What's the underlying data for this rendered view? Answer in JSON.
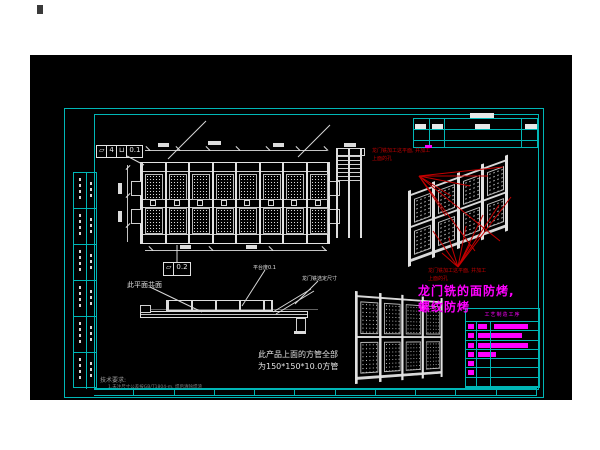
{
  "canvas": {
    "bg": "#000000",
    "line_color": "#e2e2e2",
    "border_color": "#00b6b6",
    "red": "#c40000",
    "magenta": "#ff00ff"
  },
  "tolerance_frame_1": {
    "symbol": "▱",
    "count": "4",
    "modifier": "⊔",
    "value": "0.1"
  },
  "tolerance_frame_2": {
    "symbol": "▱",
    "value": "0.2"
  },
  "notes": {
    "coplanar": "此平面共面",
    "platform_flatness": "平台度0.1",
    "mill_dims": "龙门铣选定尺寸",
    "red_machining_1": "龙门铣加工这平面, 并加工",
    "red_machining_2": "上面的孔",
    "magenta_1": "龙门铣的面防烤,",
    "magenta_2": "螺纹防烤",
    "product_1": "此产品上面的方管全部",
    "product_2": "为150*150*10.0方管",
    "tech_title": "技术要求:",
    "tech_item": "1.未注尺寸公差按GB/T1804-m, 焊后清除焊渣"
  },
  "bom": {
    "header": "工艺制造工序",
    "rows": [
      {
        "lead": true,
        "mid": 9,
        "bar": 34
      },
      {
        "lead": true,
        "mid": 44
      },
      {
        "lead": true,
        "mid": 50
      },
      {
        "lead": true,
        "mid": 18
      },
      {
        "lead": true
      },
      {
        "lead": true
      },
      {}
    ]
  },
  "plan": {
    "bays": 8,
    "panel_rows": 2
  },
  "iso_upper": {
    "cols": 4,
    "rows": 2
  },
  "iso_lower": {
    "cols": 4,
    "rows": 2
  },
  "sidebar": {
    "rows": 6
  },
  "bottom_strip": {
    "cells": 11
  }
}
